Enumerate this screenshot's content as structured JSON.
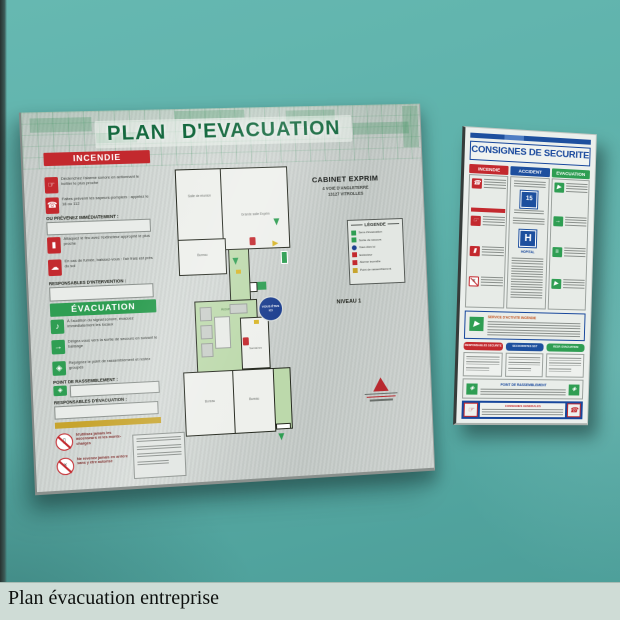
{
  "colors": {
    "wall": "#58aea7",
    "aluminium": "#ccd2cf",
    "green": "#2f9e53",
    "title_green": "#15693f",
    "red": "#c3292e",
    "blue": "#1d4f9e",
    "yellow": "#c7a42e"
  },
  "caption": {
    "title": "Plan évacuation entreprise"
  },
  "icons": {
    "alarm_hand": "☞",
    "phone": "☎",
    "extinguisher": "▮",
    "smoke": "☁",
    "siren": "♪",
    "exit_arrow": "→",
    "assembly": "◈",
    "run": "▶",
    "stairs": "≡",
    "no_elevator": "▯",
    "no_return": "×"
  },
  "main_sign": {
    "title": "PLAN D'EVACUATION",
    "incendie": {
      "header": "INCENDIE",
      "prevenez": "OU PRÉVENEZ IMMÉDIATEMENT :",
      "responsables": "RESPONSABLES D'INTERVENTION :",
      "rows": [
        "Déclenchez l'alarme sonore en actionnant le boîtier le plus proche",
        "Faites prévenir les sapeurs-pompiers : appelez le 18 ou 112",
        "Attaquez le feu avec l'extincteur approprié le plus proche",
        "En cas de fumée, baissez-vous : l'air frais est près du sol"
      ]
    },
    "evacuation": {
      "header": "ÉVACUATION",
      "point": "POINT DE RASSEMBLEMENT :",
      "responsables": "RESPONSABLES D'ÉVACUATION :",
      "rows": [
        "À l'audition du signal sonore, évacuez immédiatement les locaux",
        "Dirigez-vous vers la sortie de secours en suivant le balisage",
        "Rejoignez le point de rassemblement et restez groupés"
      ]
    },
    "interdictions": [
      "N'utilisez jamais les ascenseurs ni les monte-charges",
      "Ne revenez jamais en arrière sans y être autorisé"
    ],
    "site": {
      "name": "CABINET EXPRIM",
      "address1": "4 VOIE D'ANGLETERRE",
      "address2": "13127 VITROLLES"
    },
    "level": "NIVEAU 1",
    "legend": {
      "title": "LÉGENDE",
      "items": [
        {
          "label": "Sens d'évacuation"
        },
        {
          "label": "Sortie de secours"
        },
        {
          "label": "Vous êtes ici"
        },
        {
          "label": "Extincteur"
        },
        {
          "label": "Alarme incendie"
        },
        {
          "label": "Point de rassemblement"
        }
      ]
    },
    "plan": {
      "rooms": {
        "reunion": "Salle de réunion",
        "grande": "Grande salle Exprim",
        "bureau1": "Bureau",
        "accueil": "Accueil",
        "sanitaires": "Sanitaires",
        "bureau2": "Bureau",
        "bureau3": "Bureau"
      },
      "you_are_here": "VOUS ÊTES ICI"
    }
  },
  "security_sign": {
    "title": "CONSIGNES DE SECURITE",
    "columns": {
      "incendie": "INCENDIE",
      "accident": "ACCIDENT",
      "evacuation": "EVACUATION"
    },
    "samu_number": "15",
    "hospital_letter": "H",
    "hospital_label": "HOPITAL",
    "service_title": "SERVICE D'ACTIVITE INCENDIE",
    "pills": [
      "RESPONSABLES SECURITE",
      "SECOURISTES SST",
      "RESP. EVACUATION"
    ],
    "rassemblement": "POINT DE RASSEMBLEMENT",
    "generales": "CONSIGNES GENERALES"
  }
}
